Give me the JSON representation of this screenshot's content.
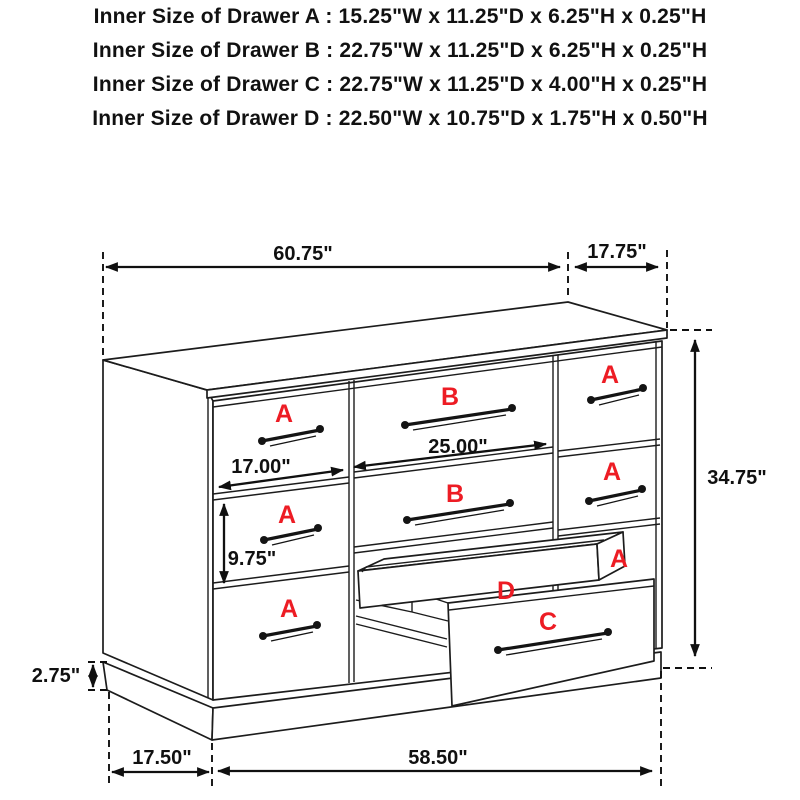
{
  "header": {
    "lines": [
      "Inner Size of Drawer A : 15.25\"W x 11.25\"D x 6.25\"H x 0.25\"H",
      "Inner Size of Drawer B : 22.75\"W x 11.25\"D x 6.25\"H x 0.25\"H",
      "Inner Size of Drawer C : 22.75\"W x 11.25\"D x 4.00\"H x 0.25\"H",
      "Inner Size of Drawer  D : 22.50\"W x 10.75\"D x 1.75\"H x 0.50\"H"
    ]
  },
  "dims": {
    "top_width": "60.75\"",
    "top_depth": "17.75\"",
    "height": "34.75\"",
    "left_drawer_width": "17.00\"",
    "center_drawer_width": "25.00\"",
    "drawer_height": "9.75\"",
    "base_height": "2.75\"",
    "depth": "17.50\"",
    "body_width": "58.50\""
  },
  "labels": {
    "a": "A",
    "b": "B",
    "c": "C",
    "d": "D"
  },
  "colors": {
    "line": "#1c1c1c",
    "label_red": "#ed1c24",
    "background": "#ffffff"
  }
}
